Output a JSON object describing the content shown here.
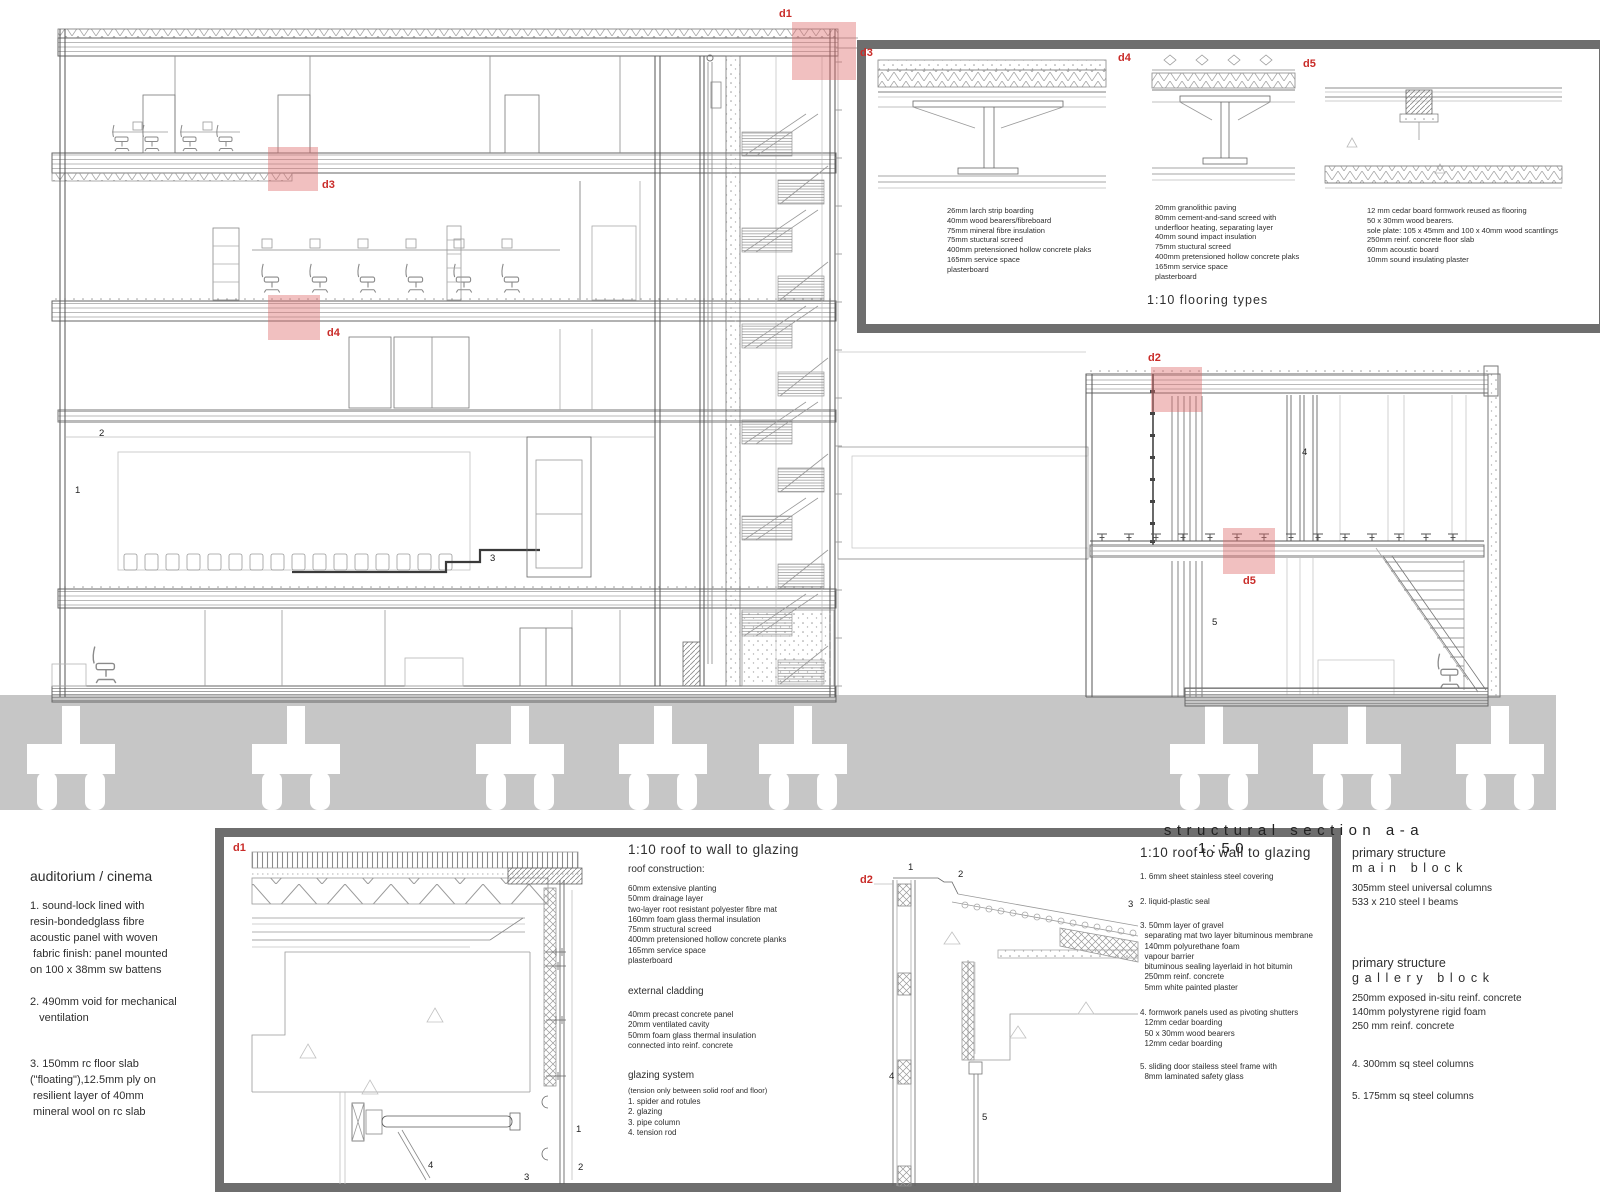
{
  "page_title": {
    "text": "structural section a-a",
    "scale": "1:50"
  },
  "detail_labels": {
    "d1": "d1",
    "d2": "d2",
    "d3": "d3",
    "d4": "d4",
    "d5": "d5"
  },
  "numerals": {
    "1": "1",
    "2": "2",
    "3": "3",
    "4": "4",
    "5": "5"
  },
  "colors": {
    "highlight_pink": "#dd6a6a",
    "label_red": "#c92b28",
    "ground_grey": "#c6c6c6",
    "panel_border": "#6e6e6e"
  },
  "flooring_panel": {
    "title": "1:10 flooring types",
    "d3_lines": [
      "26mm larch strip boarding",
      "40mm wood bearers/fibreboard",
      "75mm mineral fibre insulation",
      "75mm stuctural screed",
      "400mm pretensioned hollow concrete plaks",
      "165mm service space",
      "plasterboard"
    ],
    "d4_lines": [
      "20mm granolithic paving",
      "80mm cement-and-sand screed with",
      "underfloor heating, separating layer",
      "40mm sound impact insulation",
      "75mm stuctural screed",
      "400mm pretensioned hollow concrete plaks",
      "165mm service space",
      "plasterboard"
    ],
    "d5_lines": [
      "12 mm cedar board formwork reused as flooring",
      "50 x 30mm wood bearers.",
      "sole plate: 105 x 45mm and 100 x 40mm wood scantlings",
      "250mm reinf. concrete floor slab",
      "60mm acoustic board",
      "10mm sound insulating plaster"
    ]
  },
  "auditorium_notes": {
    "title": "auditorium / cinema",
    "item1": [
      "1. sound-lock lined with",
      "resin-bondedglass fibre",
      "acoustic panel with woven",
      " fabric finish: panel mounted",
      "on 100 x 38mm sw battens"
    ],
    "item2": [
      "2. 490mm void for mechanical",
      "   ventilation"
    ],
    "item3": [
      "3. 150mm rc floor slab",
      "(\"floating\"),12.5mm ply on",
      " resilient layer of 40mm",
      " mineral wool on rc slab"
    ]
  },
  "roof_glazing_left": {
    "title": "1:10 roof to wall to glazing",
    "s1_heading": "roof construction:",
    "s1_lines": [
      "60mm extensive planting",
      "50mm drainage layer",
      "two-layer root resistant polyester fibre  mat",
      "160mm foam glass thermal insulation",
      "75mm structural screed",
      "400mm pretensioned hollow concrete planks",
      "165mm service space",
      "plasterboard"
    ],
    "s2_heading": "external cladding",
    "s2_lines": [
      "40mm precast concrete panel",
      "20mm ventilated cavity",
      "50mm foam glass thermal insulation",
      "connected into reinf. concrete"
    ],
    "s3_heading": "glazing system",
    "s3_subtitle": "(tension only between solid roof and floor)",
    "s3_lines": [
      "1. spider and rotules",
      "2. glazing",
      "3. pipe column",
      "4. tension rod"
    ]
  },
  "roof_glazing_right": {
    "title": "1:10 roof to wall to glazing",
    "item1": "1. 6mm sheet stainless steel covering",
    "item2": "2. liquid-plastic seal",
    "item3": [
      "3. 50mm layer of gravel",
      "  separating mat two layer bituminous membrane",
      "  140mm polyurethane foam",
      "  vapour barrier",
      "  bituminous sealing layerlaid in hot bitumin",
      "  250mm reinf. concrete",
      "  5mm white painted plaster"
    ],
    "item4": [
      "4. formwork panels used as pivoting shutters",
      "  12mm cedar boarding",
      "  50 x 30mm wood bearers",
      "  12mm cedar boarding"
    ],
    "item5": [
      "5. sliding door stailess steel frame with",
      "  8mm laminated safety glass"
    ]
  },
  "primary_structure": {
    "block1_title": "primary structure",
    "block1_subtitle": "main block",
    "block1_lines": [
      "305mm steel universal columns",
      "533 x 210 steel I beams"
    ],
    "block2_title": "primary structure",
    "block2_subtitle": "gallery block",
    "block2_lines": [
      "250mm exposed in-situ reinf. concrete",
      "140mm polystyrene rigid foam",
      "250 mm reinf. concrete"
    ],
    "note4": "4. 300mm sq steel columns",
    "note5": "5. 175mm sq steel columns"
  }
}
